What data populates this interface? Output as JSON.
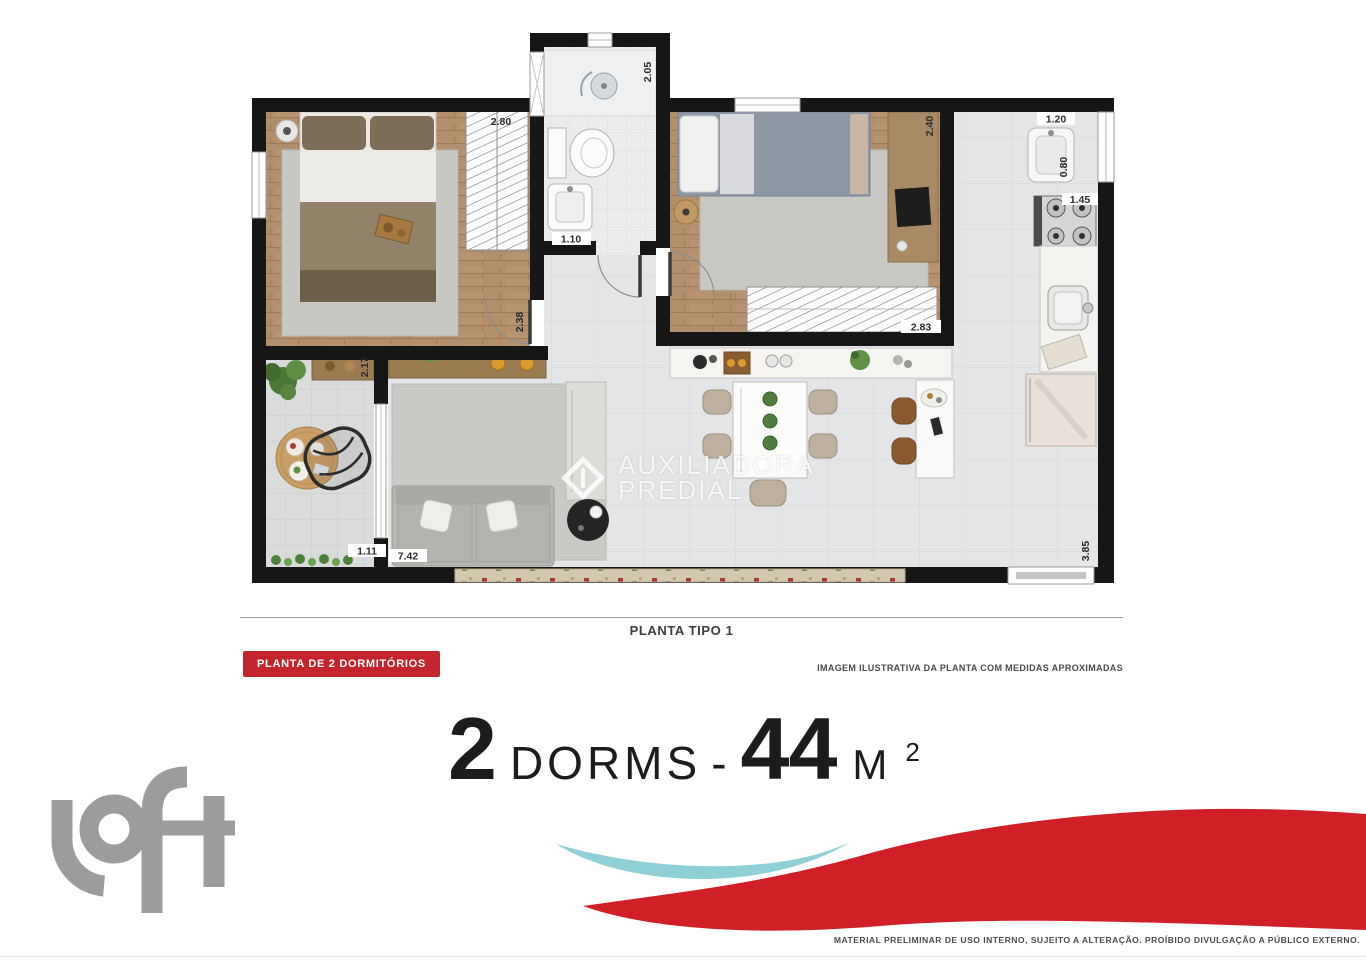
{
  "plan": {
    "caption": "PLANTA TIPO 1",
    "badge_label": "PLANTA DE 2 DORMITÓRIOS",
    "note": "IMAGEM ILUSTRATIVA DA PLANTA COM MEDIDAS APROXIMADAS",
    "watermark": {
      "line1": "AUXILIADORA",
      "line2": "PREDIAL"
    },
    "dimensions": {
      "closet1_width": "2.80",
      "shower_depth": "2.05",
      "bath_width": "1.10",
      "bedroom1_door": "2.38",
      "bedroom2_depth": "2.40",
      "closet2_width": "2.83",
      "laundry_width": "1.20",
      "laundry_depth": "0.80",
      "stove_width": "1.45",
      "kitchen_depth": "3.85",
      "terrace_depth": "2.17",
      "terrace_width": "1.11",
      "living_width": "7.42"
    }
  },
  "summary": {
    "dorms_count": "2",
    "dorms_label": "DORMS",
    "separator": "-",
    "area_value": "44",
    "area_unit": "M",
    "area_unit_exponent": "2"
  },
  "footer": {
    "logo_text": "loft",
    "disclaimer": "MATERIAL PRELIMINAR DE USO INTERNO, SUJEITO A ALTERAÇÃO. PROÍBIDO DIVULGAÇÃO A PÚBLICO EXTERNO."
  },
  "colors": {
    "badge_red": "#c4242b",
    "wave_red": "#d01f27",
    "wave_teal": "#8ed0d6",
    "logo_gray": "#9c9c9c",
    "wall_black": "#161616"
  }
}
